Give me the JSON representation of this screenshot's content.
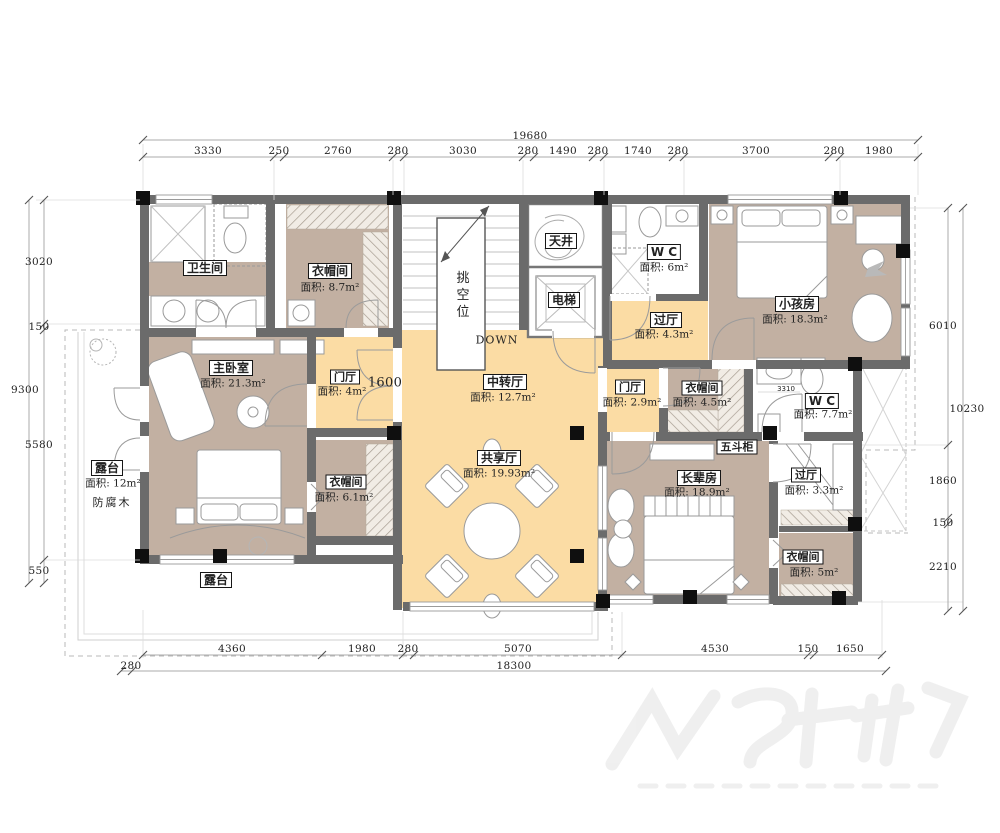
{
  "colors": {
    "hall_fill": "#FBDCA4",
    "room_fill": "#C2B0A2",
    "wall": "#6B6B6B",
    "column": "#0F0F0F",
    "dim_text": "#3C3C3C"
  },
  "rooms": {
    "bathroom": {
      "name": "卫生间"
    },
    "cloak_nw": {
      "name": "衣帽间",
      "area": "面积: 8.7m²"
    },
    "skywell": {
      "name": "天井"
    },
    "elevator": {
      "name": "电梯"
    },
    "wc_north": {
      "name": "W C",
      "area": "面积: 6m²"
    },
    "hall_ne": {
      "name": "过厅",
      "area": "面积: 4.3m²"
    },
    "kids_room": {
      "name": "小孩房",
      "area": "面积: 18.3m²"
    },
    "foyer_west": {
      "name": "门厅",
      "area": "面积: 4m²"
    },
    "mid_hall": {
      "name": "中转厅",
      "area": "面积: 12.7m²"
    },
    "foyer_east": {
      "name": "门厅",
      "area": "面积: 2.9m²"
    },
    "cloak_mid": {
      "name": "衣帽间",
      "area": "面积: 4.5m²"
    },
    "wc_east": {
      "name": "W C",
      "area": "面积: 7.7m²"
    },
    "master": {
      "name": "主卧室",
      "area": "面积: 21.3m²"
    },
    "terrace_west": {
      "name": "露台",
      "area": "面积: 12m²",
      "note": "防腐木"
    },
    "cloak_sw": {
      "name": "衣帽间",
      "area": "面积: 6.1m²"
    },
    "shared_hall": {
      "name": "共享厅",
      "area": "面积: 19.93m²"
    },
    "elder_room": {
      "name": "长辈房",
      "area": "面积: 18.9m²"
    },
    "dresser": {
      "name": "五斗柜"
    },
    "hall_se": {
      "name": "过厅",
      "area": "面积: 3.3m²"
    },
    "cloak_se": {
      "name": "衣帽间",
      "area": "面积: 5m²"
    },
    "terrace_south": {
      "name": "露台"
    }
  },
  "annotations": {
    "down": "DOWN",
    "stair_void": "挑空位",
    "foyer_width": "1600",
    "wc_fixture_dim": "3310"
  },
  "dims": {
    "top": {
      "total": "19680",
      "segments": [
        "3330",
        "250",
        "2760",
        "280",
        "3030",
        "280",
        "1490",
        "280",
        "1740",
        "280",
        "3700",
        "280",
        "1980"
      ]
    },
    "bottom": {
      "total": "18300",
      "left_offset": "280",
      "segments": [
        "4360",
        "1980",
        "280",
        "5070",
        "4530",
        "150",
        "1650"
      ]
    },
    "left": {
      "total": "9300",
      "segments": [
        "3020",
        "150",
        "5580",
        "550"
      ]
    },
    "right": {
      "total": "10230",
      "segments": [
        "6010",
        "1860",
        "150",
        "2210"
      ]
    }
  }
}
